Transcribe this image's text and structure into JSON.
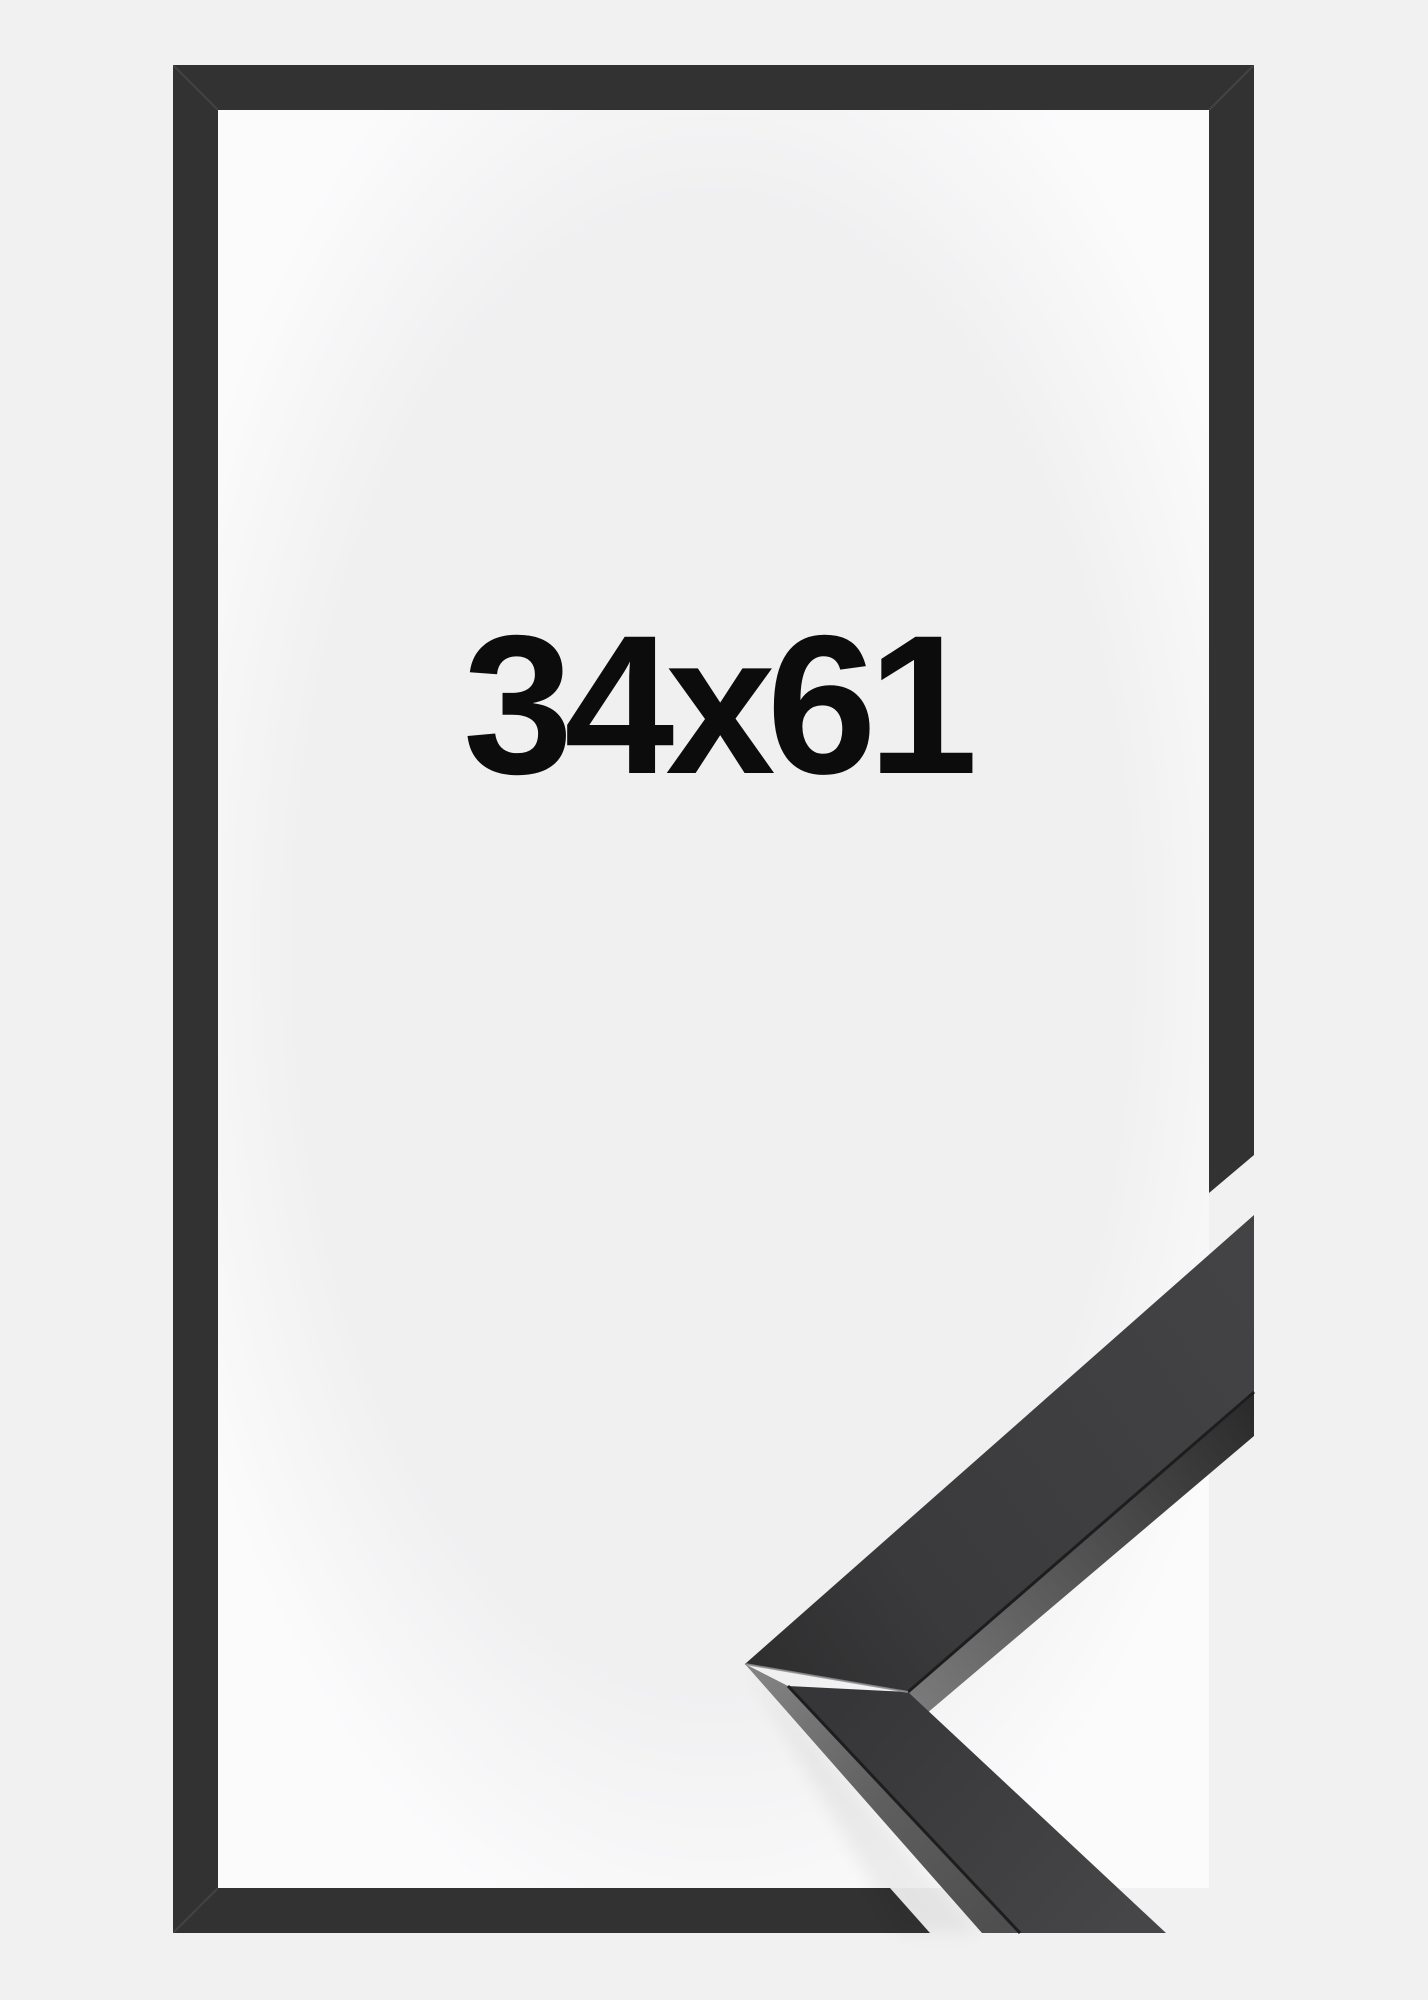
{
  "product": {
    "size_label": "34x61",
    "size_width": "34",
    "size_height": "61",
    "size_separator": "x"
  },
  "colors": {
    "background": "#f1f1f2",
    "frame-dark": "#323233",
    "interior-center": "#f0f0f1",
    "interior-edge": "#fbfbfc",
    "label-text": "#0c0c0c",
    "profile-top-face": "#414143",
    "profile-side-face": "#6b6b6b"
  }
}
